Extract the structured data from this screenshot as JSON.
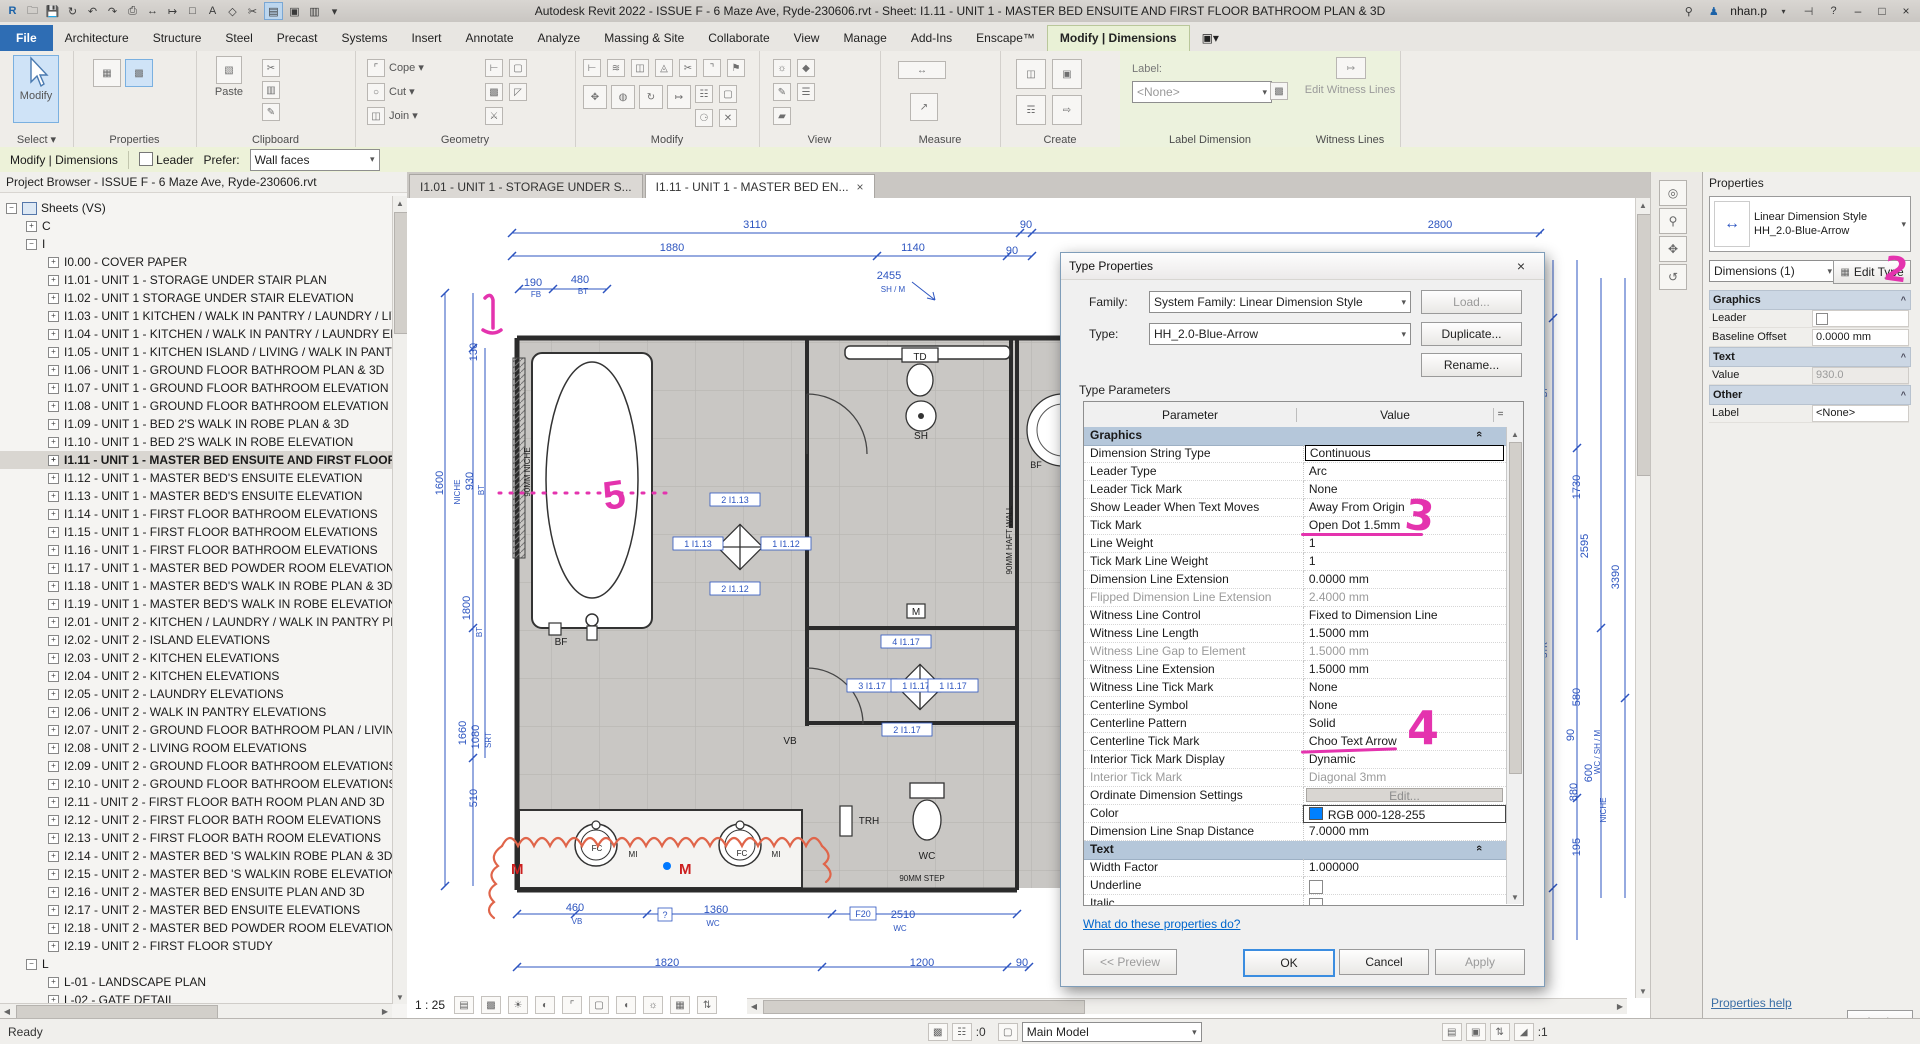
{
  "title_bar": {
    "title": "Autodesk Revit 2022 - ISSUE F - 6 Maze Ave, Ryde-230606.rvt - Sheet: I1.11 - UNIT 1 - MASTER BED ENSUITE AND FIRST FLOOR BATHROOM PLAN & 3D",
    "user": "nhan.p"
  },
  "ribbon": {
    "tabs": [
      "File",
      "Architecture",
      "Structure",
      "Steel",
      "Precast",
      "Systems",
      "Insert",
      "Annotate",
      "Analyze",
      "Massing & Site",
      "Collaborate",
      "View",
      "Manage",
      "Add-Ins",
      "Enscape™",
      "Modify | Dimensions"
    ],
    "active_tab": "Modify | Dimensions",
    "select_label": "Select ▾",
    "modify_big": "Modify",
    "paste_label": "Paste",
    "groups": [
      "Properties",
      "Clipboard",
      "Geometry",
      "Modify",
      "View",
      "Measure",
      "Create",
      "Label Dimension",
      "Witness Lines"
    ],
    "geometry_items": [
      "Cope ▾",
      "Cut ▾",
      "Join ▾"
    ],
    "label_dimension": {
      "label": "Label:",
      "value": "<None>"
    },
    "witness_button": "Edit Witness Lines"
  },
  "options_bar": {
    "context": "Modify | Dimensions",
    "leader": "Leader",
    "prefer_label": "Prefer:",
    "prefer_value": "Wall faces"
  },
  "project_browser": {
    "title": "Project Browser - ISSUE F - 6 Maze Ave, Ryde-230606.rvt",
    "root": "Sheets (VS)",
    "node_c": "C",
    "node_i": "I",
    "items": [
      "I0.00 - COVER PAPER",
      "I1.01 - UNIT 1 - STORAGE UNDER STAIR PLAN",
      "I1.02 - UNIT 1 STORAGE UNDER STAIR ELEVATION",
      "I1.03 - UNIT 1 KITCHEN / WALK IN PANTRY / LAUNDRY / LIVING",
      "I1.04 - UNIT 1 - KITCHEN / WALK IN PANTRY / LAUNDRY ELEVATION",
      "I1.05 - UNIT 1 - KITCHEN ISLAND / LIVING / WALK IN PANTRY",
      "I1.06 - UNIT 1 - GROUND FLOOR BATHROOM PLAN & 3D",
      "I1.07 - UNIT 1 - GROUND FLOOR BATHROOM ELEVATION",
      "I1.08 - UNIT 1 - GROUND FLOOR BATHROOM ELEVATION",
      "I1.09 - UNIT 1 - BED 2'S WALK IN ROBE PLAN & 3D",
      "I1.10 - UNIT 1 - BED 2'S WALK IN ROBE ELEVATION",
      "I1.11 - UNIT 1 - MASTER BED ENSUITE AND FIRST FLOOR BATHROOM",
      "I1.12 - UNIT 1 - MASTER BED'S ENSUITE ELEVATION",
      "I1.13 - UNIT 1 - MASTER BED'S ENSUITE ELEVATION",
      "I1.14 - UNIT 1 - FIRST FLOOR BATHROOM ELEVATIONS",
      "I1.15 - UNIT 1 - FIRST FLOOR BATHROOM ELEVATIONS",
      "I1.16 - UNIT 1 - FIRST FLOOR BATHROOM ELEVATIONS",
      "I1.17 - UNIT 1 - MASTER BED POWDER ROOM ELEVATIONS",
      "I1.18 - UNIT 1 - MASTER BED'S WALK IN ROBE PLAN & 3D",
      "I1.19 - UNIT 1 - MASTER BED'S WALK IN ROBE ELEVATIONS",
      "I2.01 - UNIT 2 - KITCHEN / LAUNDRY / WALK IN PANTRY PLAN",
      "I2.02 - UNIT 2 - ISLAND ELEVATIONS",
      "I2.03 - UNIT 2 - KITCHEN ELEVATIONS",
      "I2.04 - UNIT 2 - KITCHEN ELEVATIONS",
      "I2.05 - UNIT 2 - LAUNDRY ELEVATIONS",
      "I2.06 - UNIT 2 - WALK IN PANTRY ELEVATIONS",
      "I2.07 - UNIT 2 - GROUND FLOOR BATHROOM PLAN / LIVING ROOM",
      "I2.08 - UNIT 2 - LIVING ROOM ELEVATIONS",
      "I2.09 - UNIT 2 - GROUND FLOOR BATHROOM ELEVATIONS",
      "I2.10 - UNIT 2 - GROUND FLOOR BATHROOM ELEVATIONS",
      "I2.11 - UNIT 2 - FIRST FLOOR BATH ROOM PLAN AND 3D",
      "I2.12 - UNIT 2 - FIRST FLOOR BATH ROOM ELEVATIONS",
      "I2.13 - UNIT 2 - FIRST FLOOR BATH ROOM ELEVATIONS",
      "I2.14 - UNIT 2 - MASTER BED 'S WALKIN ROBE PLAN & 3D",
      "I2.15 - UNIT 2 - MASTER BED 'S WALKIN ROBE ELEVATIONS",
      "I2.16 - UNIT 2 - MASTER BED ENSUITE PLAN AND 3D",
      "I2.17 - UNIT 2 - MASTER BED ENSUITE ELEVATIONS",
      "I2.18 - UNIT 2 - MASTER BED POWDER ROOM ELEVATIONS",
      "I2.19 - UNIT 2 - FIRST FLOOR STUDY"
    ],
    "selected_index": 11,
    "node_l": "L",
    "l_children": [
      "L-01 - LANDSCAPE PLAN",
      "L-02 - GATE DETAIL"
    ]
  },
  "view_tabs": [
    {
      "label": "I1.01 - UNIT 1 - STORAGE UNDER S...",
      "active": false
    },
    {
      "label": "I1.11 - UNIT 1 - MASTER BED EN...",
      "active": true
    }
  ],
  "dialog": {
    "title": "Type Properties",
    "family_label": "Family:",
    "family_value": "System Family: Linear Dimension Style",
    "type_label": "Type:",
    "type_value": "HH_2.0-Blue-Arrow",
    "load_button": "Load...",
    "duplicate_button": "Duplicate...",
    "rename_button": "Rename...",
    "type_parameters_label": "Type Parameters",
    "col_parameter": "Parameter",
    "col_value": "Value",
    "col_eq": "=",
    "rows": [
      {
        "p": "Graphics",
        "type": "section"
      },
      {
        "p": "Dimension String Type",
        "v": "Continuous",
        "type": "focus"
      },
      {
        "p": "Leader Type",
        "v": "Arc"
      },
      {
        "p": "Leader Tick Mark",
        "v": "None"
      },
      {
        "p": "Show Leader When Text Moves",
        "v": "Away From Origin"
      },
      {
        "p": "Tick Mark",
        "v": "Open Dot 1.5mm"
      },
      {
        "p": "Line Weight",
        "v": "1"
      },
      {
        "p": "Tick Mark Line Weight",
        "v": "1"
      },
      {
        "p": "Dimension Line Extension",
        "v": "0.0000 mm"
      },
      {
        "p": "Flipped Dimension Line Extension",
        "v": "2.4000 mm",
        "type": "gray"
      },
      {
        "p": "Witness Line Control",
        "v": "Fixed to Dimension Line"
      },
      {
        "p": "Witness Line Length",
        "v": "1.5000 mm"
      },
      {
        "p": "Witness Line Gap to Element",
        "v": "1.5000 mm",
        "type": "gray"
      },
      {
        "p": "Witness Line Extension",
        "v": "1.5000 mm"
      },
      {
        "p": "Witness Line Tick Mark",
        "v": "None"
      },
      {
        "p": "Centerline Symbol",
        "v": "None"
      },
      {
        "p": "Centerline Pattern",
        "v": "Solid"
      },
      {
        "p": "Centerline Tick Mark",
        "v": "Choo Text Arrow"
      },
      {
        "p": "Interior Tick Mark Display",
        "v": "Dynamic"
      },
      {
        "p": "Interior Tick Mark",
        "v": "Diagonal 3mm",
        "type": "gray"
      },
      {
        "p": "Ordinate Dimension Settings",
        "v": "Edit...",
        "type": "button"
      },
      {
        "p": "Color",
        "v": "RGB 000-128-255",
        "type": "color"
      },
      {
        "p": "Dimension Line Snap Distance",
        "v": "7.0000 mm"
      },
      {
        "p": "Text",
        "type": "section"
      },
      {
        "p": "Width Factor",
        "v": "1.000000"
      },
      {
        "p": "Underline",
        "v": "",
        "type": "check"
      },
      {
        "p": "Italic",
        "v": "",
        "type": "check"
      }
    ],
    "link": "What do these properties do?",
    "preview_button": "<< Preview",
    "ok_button": "OK",
    "cancel_button": "Cancel",
    "apply_button": "Apply",
    "accent_color": "#0080ff"
  },
  "properties_panel": {
    "header": "Properties",
    "type_line1": "Linear Dimension Style",
    "type_line2": "HH_2.0-Blue-Arrow",
    "selector": "Dimensions (1)",
    "edit_type": "Edit Type",
    "rows": [
      {
        "p": "Graphics",
        "type": "section"
      },
      {
        "p": "Leader",
        "v": "",
        "type": "check"
      },
      {
        "p": "Baseline Offset",
        "v": "0.0000 mm"
      },
      {
        "p": "Text",
        "type": "section"
      },
      {
        "p": "Value",
        "v": "930.0",
        "type": "gray"
      },
      {
        "p": "Other",
        "type": "section"
      },
      {
        "p": "Label",
        "v": "<None>"
      }
    ],
    "help_link": "Properties help",
    "apply_button": "Apply"
  },
  "canvas": {
    "scale_label": "1 : 25",
    "dim_color": "#2d55c0",
    "dims": [
      {
        "t": "3110",
        "x": 348,
        "y": 30
      },
      {
        "t": "90",
        "x": 619,
        "y": 30
      },
      {
        "t": "2800",
        "x": 1033,
        "y": 30
      },
      {
        "t": "1880",
        "x": 265,
        "y": 53
      },
      {
        "t": "1140",
        "x": 506,
        "y": 53
      },
      {
        "t": "90",
        "x": 605,
        "y": 56
      },
      {
        "t": "190",
        "x": 126,
        "y": 88
      },
      {
        "t": "FB",
        "x": 129,
        "y": 99,
        "s": 8
      },
      {
        "t": "480",
        "x": 173,
        "y": 85
      },
      {
        "t": "BT",
        "x": 176,
        "y": 96,
        "s": 8
      },
      {
        "t": "2455",
        "x": 482,
        "y": 81
      },
      {
        "t": "SH / M",
        "x": 486,
        "y": 94,
        "s": 8
      },
      {
        "t": "130",
        "x": 70,
        "y": 154,
        "r": 1
      },
      {
        "t": "1600",
        "x": 36,
        "y": 285,
        "r": 1
      },
      {
        "t": "NICHE",
        "x": 53,
        "y": 294,
        "r": 1,
        "s": 8
      },
      {
        "t": "930",
        "x": 66,
        "y": 283,
        "r": 1
      },
      {
        "t": "BT",
        "x": 77,
        "y": 292,
        "r": 1,
        "s": 8
      },
      {
        "t": "1800",
        "x": 63,
        "y": 410,
        "r": 1
      },
      {
        "t": "BT",
        "x": 75,
        "y": 434,
        "r": 1,
        "s": 8
      },
      {
        "t": "1660",
        "x": 59,
        "y": 535,
        "r": 1
      },
      {
        "t": "1080",
        "x": 72,
        "y": 539,
        "r": 1
      },
      {
        "t": "SRT",
        "x": 84,
        "y": 542,
        "r": 1,
        "s": 8
      },
      {
        "t": "510",
        "x": 70,
        "y": 600,
        "r": 1
      },
      {
        "t": "460",
        "x": 168,
        "y": 713
      },
      {
        "t": "VB",
        "x": 170,
        "y": 726,
        "s": 8
      },
      {
        "t": "1360",
        "x": 309,
        "y": 715
      },
      {
        "t": "WC",
        "x": 306,
        "y": 728,
        "s": 8
      },
      {
        "t": "2510",
        "x": 496,
        "y": 720
      },
      {
        "t": "WC",
        "x": 493,
        "y": 733,
        "s": 8
      },
      {
        "t": "1820",
        "x": 260,
        "y": 768
      },
      {
        "t": "1200",
        "x": 515,
        "y": 768
      },
      {
        "t": "90",
        "x": 615,
        "y": 768
      },
      {
        "t": "BT",
        "x": 1140,
        "y": 194,
        "r": 1,
        "s": 8
      },
      {
        "t": "1730",
        "x": 1173,
        "y": 289,
        "r": 1
      },
      {
        "t": "2595",
        "x": 1181,
        "y": 348,
        "r": 1
      },
      {
        "t": "3390",
        "x": 1212,
        "y": 379,
        "r": 1
      },
      {
        "t": "STR",
        "x": 1140,
        "y": 452,
        "r": 1,
        "s": 8
      },
      {
        "t": "580",
        "x": 1173,
        "y": 499,
        "r": 1
      },
      {
        "t": "90",
        "x": 1167,
        "y": 537,
        "r": 1
      },
      {
        "t": "WC / SH / M",
        "x": 1193,
        "y": 554,
        "r": 1,
        "s": 8
      },
      {
        "t": "600",
        "x": 1185,
        "y": 575,
        "r": 1
      },
      {
        "t": "880",
        "x": 1170,
        "y": 594,
        "r": 1
      },
      {
        "t": "NICHE",
        "x": 1199,
        "y": 612,
        "r": 1,
        "s": 8
      },
      {
        "t": "195",
        "x": 1173,
        "y": 649,
        "r": 1
      }
    ],
    "plan_labels": [
      {
        "t": "TD",
        "x": 513,
        "y": 162
      },
      {
        "t": "SH",
        "x": 514,
        "y": 241
      },
      {
        "t": "BF",
        "x": 154,
        "y": 447
      },
      {
        "t": "M",
        "x": 509,
        "y": 417
      },
      {
        "t": "VB",
        "x": 383,
        "y": 546
      },
      {
        "t": "TRH",
        "x": 462,
        "y": 626
      },
      {
        "t": "WC",
        "x": 520,
        "y": 661
      },
      {
        "t": "90MM STEP",
        "x": 515,
        "y": 683,
        "s": 8
      },
      {
        "t": "FC",
        "x": 190,
        "y": 653,
        "s": 8
      },
      {
        "t": "MI",
        "x": 226,
        "y": 659,
        "s": 8
      },
      {
        "t": "FC",
        "x": 335,
        "y": 658,
        "s": 8
      },
      {
        "t": "MI",
        "x": 369,
        "y": 659,
        "s": 8
      },
      {
        "t": "90MM HAFT WALL",
        "x": 605,
        "y": 342,
        "r": 1,
        "s": 8
      },
      {
        "t": "90MM NICHE",
        "x": 123,
        "y": 274,
        "r": 1,
        "s": 8
      },
      {
        "t": "BF",
        "x": 629,
        "y": 270,
        "s": 9
      }
    ],
    "elev_tags": [
      {
        "t": "2 I1.13",
        "x": 328,
        "y": 305
      },
      {
        "t": "1 I1.13",
        "x": 291,
        "y": 349
      },
      {
        "t": "1 I1.12",
        "x": 379,
        "y": 349
      },
      {
        "t": "2 I1.12",
        "x": 328,
        "y": 394
      },
      {
        "t": "4 I1.17",
        "x": 499,
        "y": 447
      },
      {
        "t": "3 I1.17",
        "x": 465,
        "y": 491
      },
      {
        "t": "1 I1.17",
        "x": 509,
        "y": 491
      },
      {
        "t": "1 I1.17",
        "x": 546,
        "y": 491
      },
      {
        "t": "2 I1.17",
        "x": 500,
        "y": 535
      },
      {
        "t": "F20",
        "x": 456,
        "y": 719,
        "box": 1
      },
      {
        "t": "?",
        "x": 258,
        "y": 720,
        "box": 1
      }
    ],
    "annotations": {
      "n1": "1",
      "n2": "2",
      "n3": "3",
      "n4": "4",
      "n5": "5",
      "m1": "M",
      "m2": "M"
    }
  },
  "status_bar": {
    "ready": "Ready",
    "counter_left": ":0",
    "main_model": "Main Model",
    "counter_right": ":1"
  }
}
